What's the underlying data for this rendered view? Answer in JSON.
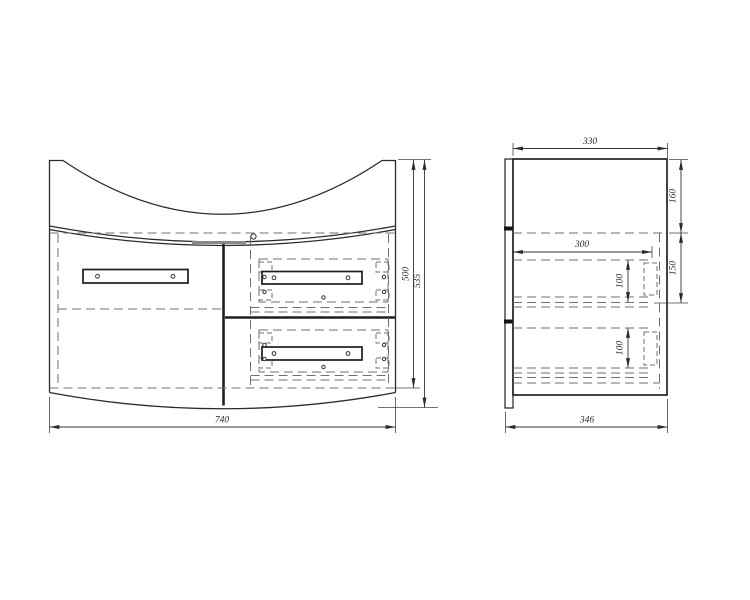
{
  "drawing": {
    "type": "furniture-technical-drawing",
    "background_color": "#ffffff",
    "line_color": "#2b2b2b",
    "hidden_line_color": "#6f6f6f",
    "front_view": {
      "name": "front view",
      "dims": {
        "width": "740",
        "carcass_height": "500",
        "overall_height": "535"
      }
    },
    "side_view": {
      "name": "side view",
      "dims": {
        "top_depth": "330",
        "upper_section": "160",
        "drawer_section": "150",
        "drawer_slide_length": "300",
        "top_drawer_height": "100",
        "bottom_drawer_height": "100",
        "bottom_depth": "346"
      }
    }
  }
}
